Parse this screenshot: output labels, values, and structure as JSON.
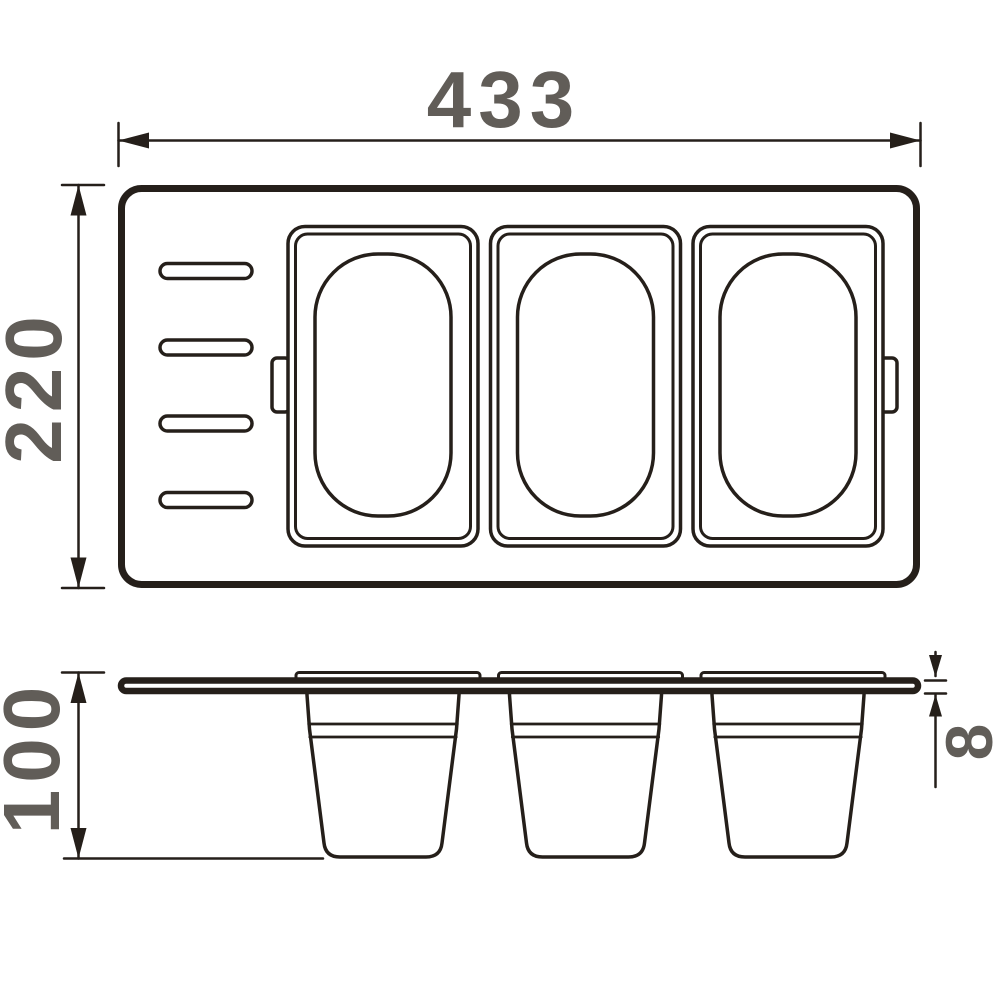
{
  "drawing": {
    "type": "technical-dimension-drawing",
    "colors": {
      "line": "#251f1a",
      "label": "#615d58",
      "background": "#ffffff"
    },
    "labels": {
      "overall_width": "433",
      "overall_depth": "220",
      "container_depth": "100",
      "tray_thickness": "8"
    },
    "views": {
      "top": {
        "knife_slots": 4,
        "containers": 3,
        "handle_tabs": 2
      },
      "side": {
        "containers": 3,
        "container_rims": 3
      }
    }
  }
}
